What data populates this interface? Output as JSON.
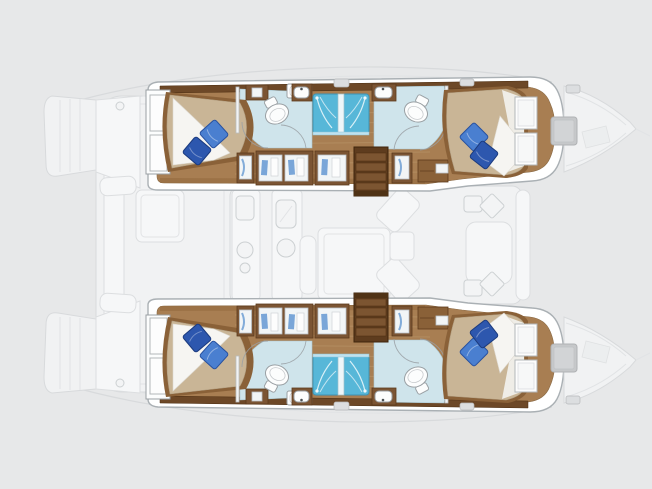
{
  "meta": {
    "title": "Catamaran interior layout floor plan",
    "view": "top-down deck plan, bows pointing right",
    "visible_text": ""
  },
  "colors": {
    "background": "#e7e8e9",
    "floor_wood": "#a87e52",
    "floor_shadow": "#8f6539",
    "furniture_wood": "#7b5433",
    "bed_frame_wood": "#8a6138",
    "dark_wood": "#5e3c1e",
    "steps_dark": "#4f3215",
    "tread_wood": "#7c5531",
    "trim_wood": "#6d4827",
    "mattress_tan": "#c9b596",
    "sheet_white": "#f6f5f2",
    "head_sheet": "#efede7",
    "pillow_light": "#4a7fd0",
    "pillow_dark": "#2d57ae",
    "bath_floor_blue": "#cfe4eb",
    "shower_blue": "#57b7d8",
    "shower_glass": "#bfe2ef",
    "garment_blue": "#7aa6d8",
    "hatch_gray": "#c6c8ca",
    "hatch_gray_inner": "#d2d4d6",
    "deck_hatch": "#dcdee0"
  },
  "layout": {
    "hulls": [
      {
        "side": "top hull",
        "aft_cabin": {
          "bed": "island double berth",
          "pillows": 2,
          "windows": 2
        },
        "aft_bathroom": {
          "toilet": 1,
          "sink": 1
        },
        "shower_stalls": 2,
        "vanity_sinks": 2,
        "forward_bathroom": {
          "toilet": 1,
          "sink": 1
        },
        "forward_cabin": {
          "bed": "island double berth",
          "pillows": 2,
          "windows": 2
        },
        "features": [
          "companionway steps",
          "wardrobes with hanging clothes",
          "bow deck window",
          "deck hatches"
        ]
      },
      {
        "side": "bottom hull",
        "note": "mirror image of top hull",
        "aft_cabin": {
          "bed": "island double berth",
          "pillows": 2,
          "windows": 2
        },
        "aft_bathroom": {
          "toilet": 1,
          "sink": 1
        },
        "shower_stalls": 2,
        "vanity_sinks": 2,
        "forward_bathroom": {
          "toilet": 1,
          "sink": 1
        },
        "forward_cabin": {
          "bed": "island double berth",
          "pillows": 2,
          "windows": 2
        },
        "features": [
          "companionway steps",
          "wardrobes with hanging clothes",
          "bow deck window",
          "deck hatches"
        ]
      }
    ],
    "saloon_ghost": {
      "features": [
        "galley counters",
        "island table",
        "chaise",
        "seating cluster",
        "front lounge"
      ]
    },
    "cockpit_ghost": {
      "features": [
        "cockpit table",
        "bench",
        "transom steps"
      ]
    },
    "totals": {
      "cabins": 4,
      "heads": 4,
      "showers": 4,
      "pillows_per_bed": 2
    }
  }
}
